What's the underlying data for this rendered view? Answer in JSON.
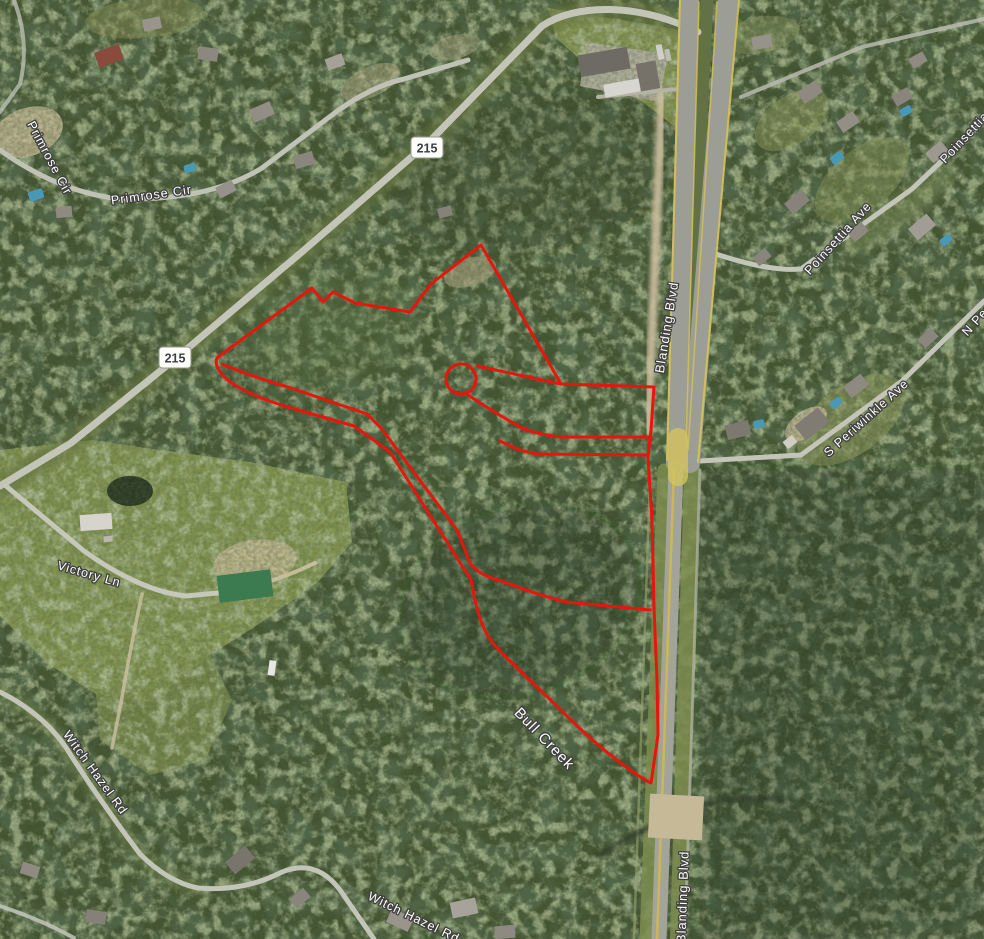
{
  "map": {
    "kind": "satellite-imagery-with-parcel-outline",
    "base_color": "#43532f",
    "boundary_color": "#e8150c",
    "pool_color": "#4898b8",
    "labels": [
      {
        "text": "Primrose Cir",
        "x": 46,
        "y": 160,
        "rot": 62,
        "size": 12.5
      },
      {
        "text": "Primrose Cir",
        "x": 152,
        "y": 199,
        "rot": -8,
        "size": 12.5
      },
      {
        "text": "Blanding Blvd",
        "x": 671,
        "y": 328,
        "rot": -81,
        "size": 13
      },
      {
        "text": "Blanding Blvd",
        "x": 687,
        "y": 897,
        "rot": -88,
        "size": 13
      },
      {
        "text": "Bull Creek",
        "x": 541,
        "y": 742,
        "rot": 46,
        "size": 15
      },
      {
        "text": "Victory Ln",
        "x": 88,
        "y": 578,
        "rot": 16,
        "size": 12.5
      },
      {
        "text": "Witch Hazel Rd",
        "x": 92,
        "y": 775,
        "rot": 54,
        "size": 12.5
      },
      {
        "text": "Witch Hazel Rd",
        "x": 412,
        "y": 921,
        "rot": 26,
        "size": 12.5
      },
      {
        "text": "Poinsettia Ave",
        "x": 977,
        "y": 130,
        "rot": -47,
        "size": 12.5
      },
      {
        "text": "Poinsettia Ave",
        "x": 841,
        "y": 241,
        "rot": -48,
        "size": 12.5
      },
      {
        "text": "S Periwinkle Ave",
        "x": 869,
        "y": 421,
        "rot": -42,
        "size": 12.5
      },
      {
        "text": "N Periwinkle Ave",
        "x": 1004,
        "y": 296,
        "rot": -48,
        "size": 12.5
      }
    ],
    "shields": [
      {
        "text": "215",
        "x": 427,
        "y": 148
      },
      {
        "text": "215",
        "x": 175,
        "y": 358
      }
    ],
    "boundary": {
      "stroke_width": 3,
      "paths": [
        "M 218,357 L 312,288 L 323,302 L 333,292 L 355,303 L 410,312 L 431,284 L 481,245 L 561,384 L 654,387 L 651,430 L 648,458 L 652,520 L 654,608 L 657,680 L 658,735 L 651,783 C 637,776 616,760 596,743 C 576,726 556,705 538,688 C 520,671 500,652 492,642 C 482,629 477,611 474,595 L 471,580 L 390,452 L 354,426 L 291,408 C 268,401 243,392 229,381 C 219,373 213,363 218,357 Z",
        "M 222,364 C 245,374 268,381 291,388 L 367,414 L 381,428 L 457,530 L 470,563 C 477,573 489,578 502,581 C 524,590 546,597 566,602 L 650,610",
        "M 477,366 L 561,384",
        "M 465,393 C 486,407 507,420 524,429 C 538,434 550,436 562,437 L 651,437",
        "M 500,441 C 516,449 527,453 538,454 L 648,455 L 648,458"
      ],
      "bulb": {
        "cx": 461,
        "cy": 379,
        "r": 15
      }
    },
    "fields": [
      {
        "name": "pasture-southwest",
        "d": "M 0,450 L 92,440 L 160,450 L 250,462 L 346,482 L 352,542 L 318,582 L 262,622 L 210,655 L 152,702 L 96,694 L 48,664 L 0,616 Z",
        "color": "#8a9a52",
        "op": 0.9
      },
      {
        "name": "pasture-lower",
        "d": "M 96,694 L 210,655 L 232,700 L 205,760 L 150,775 L 100,740 Z",
        "color": "#7f8f4c",
        "op": 0.8
      },
      {
        "name": "grass-top-center",
        "d": "M 548,8 L 660,26 L 697,34 L 676,128 L 640,100 L 592,70 L 556,38 Z",
        "color": "#8f9c55",
        "op": 0.9
      }
    ],
    "clearings": [
      {
        "name": "sand-patch",
        "cx": 28,
        "cy": 132,
        "rx": 36,
        "ry": 24,
        "rot": -20,
        "color": "#c4b893",
        "op": 0.85
      },
      {
        "name": "sand-patch",
        "cx": 370,
        "cy": 82,
        "rx": 32,
        "ry": 15,
        "rot": -25,
        "color": "#b2aa86",
        "op": 0.6
      },
      {
        "name": "sand-patch",
        "cx": 455,
        "cy": 47,
        "rx": 26,
        "ry": 12,
        "rot": -15,
        "color": "#a9a482",
        "op": 0.55
      },
      {
        "name": "clearing-in-parcel",
        "cx": 470,
        "cy": 272,
        "rx": 27,
        "ry": 14,
        "rot": -18,
        "color": "#a59d7a",
        "op": 0.75
      },
      {
        "name": "grass-clearing",
        "cx": 851,
        "cy": 420,
        "rx": 62,
        "ry": 34,
        "rot": -36,
        "color": "#939b5d",
        "op": 0.6
      },
      {
        "name": "sand-patch",
        "cx": 806,
        "cy": 424,
        "rx": 24,
        "ry": 13,
        "rot": -36,
        "color": "#c7ba96",
        "op": 0.85
      },
      {
        "name": "grass-clearing",
        "cx": 862,
        "cy": 180,
        "rx": 56,
        "ry": 30,
        "rot": -40,
        "color": "#8c9857",
        "op": 0.5
      },
      {
        "name": "grass-clearing",
        "cx": 792,
        "cy": 120,
        "rx": 42,
        "ry": 24,
        "rot": -35,
        "color": "#98a05f",
        "op": 0.5
      },
      {
        "name": "sand-yard",
        "cx": 255,
        "cy": 562,
        "rx": 42,
        "ry": 22,
        "rot": -8,
        "color": "#c8bb96",
        "op": 0.8
      },
      {
        "name": "pond",
        "cx": 130,
        "cy": 491,
        "rx": 23,
        "ry": 15,
        "rot": 0,
        "color": "#222f1e",
        "op": 0.9
      },
      {
        "name": "grass-strip",
        "cx": 900,
        "cy": 210,
        "rx": 70,
        "ry": 16,
        "rot": -38,
        "color": "#7f8e53",
        "op": 0.5,
        "blur": "b4"
      },
      {
        "name": "grass-top-edge",
        "cx": 145,
        "cy": 18,
        "rx": 60,
        "ry": 20,
        "rot": -5,
        "color": "#8f9156",
        "op": 0.5
      },
      {
        "name": "grass-clearing",
        "cx": 760,
        "cy": 35,
        "rx": 40,
        "ry": 18,
        "rot": -10,
        "color": "#87945a",
        "op": 0.5
      },
      {
        "name": "dark-forest-east",
        "d": "M 700,470 L 984,470 L 984,939 L 700,939 Z",
        "color": "#1f2c1a",
        "op": 0.28,
        "blur": "b10"
      },
      {
        "name": "dark-forest-mid",
        "cx": 520,
        "cy": 600,
        "rx": 120,
        "ry": 90,
        "rot": -20,
        "color": "#25321e",
        "op": 0.3,
        "blur": "b12"
      },
      {
        "name": "dark-forest-top",
        "cx": 530,
        "cy": 170,
        "rx": 150,
        "ry": 80,
        "rot": -10,
        "color": "#2a3822",
        "op": 0.25,
        "blur": "b12"
      },
      {
        "name": "light-canopy-west",
        "cx": 330,
        "cy": 330,
        "rx": 90,
        "ry": 60,
        "rot": -15,
        "color": "#5d7040",
        "op": 0.3,
        "blur": "b10"
      },
      {
        "name": "concrete-pad",
        "d": "M 586,42 L 668,54 L 659,102 L 580,86 Z",
        "color": "#b7b2a2",
        "op": 0.9
      }
    ],
    "roads": [
      {
        "name": "rd-215-verge",
        "d": "M 698,32 C 636,2 575,4 542,26 L 430,141 L 303,251 L 175,359 L 71,443 L 0,486",
        "w": 22,
        "color": "#66753f",
        "op": 0.7,
        "blur": "b4"
      },
      {
        "name": "witch-hazel-verge",
        "d": "M 0,692 Q 48,716 72,757 Q 103,805 140,854 Q 168,882 198,888",
        "w": 14,
        "color": "#6b7a45",
        "op": 0.6,
        "blur": "b4"
      },
      {
        "name": "blanding-verge-west",
        "d": "M 664,470 L 646,939",
        "w": 13,
        "color": "#7d8d50",
        "op": 0.85
      },
      {
        "name": "blanding-verge-east",
        "d": "M 692,470 L 678,939",
        "w": 16,
        "color": "#7d8d50",
        "op": 0.85
      },
      {
        "name": "blanding-median",
        "d": "M 707,0 L 684,445",
        "w": 13,
        "color": "#637244",
        "op": 1
      },
      {
        "name": "blanding-dirt-strip",
        "d": "M 662,92 Q 655,260 648,432",
        "w": 9,
        "color": "#ccbe9e",
        "op": 0.9,
        "blur": "b2"
      },
      {
        "name": "rd-215",
        "d": "M 698,32 C 636,2 575,4 542,26 L 430,141 L 303,251 L 175,359 L 71,443 L 0,486",
        "w": 7,
        "color": "#c3c5b9",
        "op": 1
      },
      {
        "name": "primrose-cir-rd",
        "d": "M 0,150 Q 58,192 120,199 Q 208,201 262,168 L 336,112 Q 372,86 404,79 L 468,60",
        "w": 5,
        "color": "#c0c2b6",
        "op": 1
      },
      {
        "name": "corner-rd-northwest",
        "d": "M 14,0 Q 30,42 20,84 L 0,112",
        "w": 4,
        "color": "#bcbeb2",
        "op": 0.8
      },
      {
        "name": "victory-ln-rd",
        "d": "M 6,486 L 84,551 Q 140,591 186,596 L 238,591",
        "w": 5,
        "color": "#c6c8bc",
        "op": 1
      },
      {
        "name": "victory-dirt",
        "d": "M 238,591 Q 280,580 315,563",
        "w": 4,
        "color": "#cdc1a3",
        "op": 0.9
      },
      {
        "name": "victory-driveway",
        "d": "M 142,594 Q 130,650 121,703 L 112,748",
        "w": 3.5,
        "color": "#cdc1a3",
        "op": 0.8
      },
      {
        "name": "witch-hazel-rd",
        "d": "M 0,692 Q 48,716 72,757 Q 103,805 140,854 Q 168,882 198,888 Q 243,892 282,872 Q 316,858 340,890 L 374,939",
        "w": 5,
        "color": "#c3c5b9",
        "op": 1
      },
      {
        "name": "poinsettia-ave-rd",
        "d": "M 710,252 Q 768,272 801,269 L 912,189 L 984,121",
        "w": 5,
        "color": "#c3c5b9",
        "op": 1
      },
      {
        "name": "periwinkle-ave-rd",
        "d": "M 683,462 L 801,455 L 902,381 L 984,301",
        "w": 5,
        "color": "#c3c5b9",
        "op": 1
      },
      {
        "name": "top-right-rd",
        "d": "M 741,97 L 862,47 L 984,19",
        "w": 4,
        "color": "#b8bab0",
        "op": 0.85
      },
      {
        "name": "complex-driveway",
        "d": "M 598,97 Q 645,92 689,88",
        "w": 4,
        "color": "#b5b2a6",
        "op": 1
      },
      {
        "name": "bottom-left-rd",
        "d": "M 0,906 Q 42,920 74,938",
        "w": 4,
        "color": "#bfc1b5",
        "op": 0.9
      },
      {
        "name": "blanding-west-carriageway",
        "d": "M 689,0 L 676,463",
        "w": 20,
        "color": "#9c9d94",
        "op": 1
      },
      {
        "name": "blanding-east-carriageway",
        "d": "M 728,0 L 690,463",
        "w": 20,
        "color": "#9c9d94",
        "op": 1
      },
      {
        "name": "blanding-lower",
        "d": "M 676,468 L 659,939",
        "w": 15,
        "color": "#a2a399",
        "op": 1
      },
      {
        "name": "blanding-stripe",
        "d": "M 680,0 L 667,460",
        "w": 2,
        "color": "#d8c253",
        "op": 0.9
      },
      {
        "name": "blanding-stripe",
        "d": "M 739,0 L 698,462",
        "w": 2,
        "color": "#d8c253",
        "op": 0.9
      },
      {
        "name": "blanding-stripe",
        "d": "M 699,2 L 686,445",
        "w": 1.5,
        "color": "#d8c253",
        "op": 0.8
      },
      {
        "name": "blanding-stripe",
        "d": "M 717,2 L 688,450",
        "w": 1.5,
        "color": "#d8c253",
        "op": 0.8
      },
      {
        "name": "blanding-center-stripe",
        "d": "M 674,470 L 657,939",
        "w": 2.5,
        "color": "#d2b94e",
        "op": 0.9
      },
      {
        "name": "blanding-turn-lane",
        "d": "M 678,438 L 678,476",
        "w": 20,
        "color": "#d5c35e",
        "op": 0.8
      },
      {
        "name": "shoulder-trail-east",
        "d": "M 700,470 L 685,939",
        "w": 3,
        "color": "#b5b7aa",
        "op": 0.7
      },
      {
        "name": "shoulder-trail-west",
        "d": "M 650,480 L 634,939",
        "w": 2.5,
        "color": "#9aa572",
        "op": 0.6
      },
      {
        "name": "bull-creek-channel",
        "d": "M 596,856 Q 652,822 700,806 Q 745,794 784,800",
        "w": 5,
        "color": "#2c3a26",
        "op": 0.8,
        "blur": "b2"
      }
    ],
    "buildings": [
      {
        "name": "commercial-building",
        "x": 604,
        "y": 62,
        "w": 50,
        "h": 22,
        "rot": -10,
        "color": "#6e6a64"
      },
      {
        "name": "commercial-building",
        "x": 648,
        "y": 76,
        "w": 20,
        "h": 28,
        "rot": -10,
        "color": "#767169"
      },
      {
        "name": "commercial-building",
        "x": 622,
        "y": 88,
        "w": 36,
        "h": 13,
        "rot": -10,
        "color": "#d7d5cf"
      },
      {
        "name": "truck",
        "x": 660,
        "y": 52,
        "w": 6,
        "h": 15,
        "rot": -12,
        "color": "#cfcfca"
      },
      {
        "name": "truck",
        "x": 668,
        "y": 55,
        "w": 5,
        "h": 12,
        "rot": -12,
        "color": "#bdbdb8"
      },
      {
        "name": "house",
        "x": 109,
        "y": 56,
        "w": 26,
        "h": 16,
        "rot": -20,
        "color": "#8a4a3c"
      },
      {
        "name": "house",
        "x": 152,
        "y": 24,
        "w": 18,
        "h": 12,
        "rot": -12,
        "color": "#9a958c"
      },
      {
        "name": "house",
        "x": 208,
        "y": 54,
        "w": 20,
        "h": 13,
        "rot": 8,
        "color": "#8d887f"
      },
      {
        "name": "house",
        "x": 262,
        "y": 112,
        "w": 22,
        "h": 14,
        "rot": -24,
        "color": "#938e85"
      },
      {
        "name": "house",
        "x": 304,
        "y": 160,
        "w": 20,
        "h": 13,
        "rot": -16,
        "color": "#8b867d"
      },
      {
        "name": "house",
        "x": 226,
        "y": 189,
        "w": 18,
        "h": 12,
        "rot": -28,
        "color": "#96918a"
      },
      {
        "name": "house",
        "x": 64,
        "y": 212,
        "w": 16,
        "h": 11,
        "rot": -5,
        "color": "#8f8a81"
      },
      {
        "name": "house",
        "x": 335,
        "y": 62,
        "w": 18,
        "h": 12,
        "rot": -20,
        "color": "#a6a198"
      },
      {
        "name": "house",
        "x": 445,
        "y": 212,
        "w": 14,
        "h": 10,
        "rot": -15,
        "color": "#86817a"
      },
      {
        "name": "house",
        "x": 762,
        "y": 42,
        "w": 20,
        "h": 13,
        "rot": -10,
        "color": "#98938a"
      },
      {
        "name": "house",
        "x": 810,
        "y": 92,
        "w": 22,
        "h": 14,
        "rot": -34,
        "color": "#8f8a81"
      },
      {
        "name": "house",
        "x": 848,
        "y": 122,
        "w": 20,
        "h": 13,
        "rot": -34,
        "color": "#948f86"
      },
      {
        "name": "house",
        "x": 902,
        "y": 97,
        "w": 18,
        "h": 12,
        "rot": -30,
        "color": "#8a857c"
      },
      {
        "name": "house",
        "x": 937,
        "y": 152,
        "w": 20,
        "h": 13,
        "rot": -40,
        "color": "#9e9990"
      },
      {
        "name": "house",
        "x": 797,
        "y": 202,
        "w": 22,
        "h": 14,
        "rot": -40,
        "color": "#88837a"
      },
      {
        "name": "house",
        "x": 858,
        "y": 232,
        "w": 18,
        "h": 12,
        "rot": -40,
        "color": "#8f8a81"
      },
      {
        "name": "house",
        "x": 922,
        "y": 227,
        "w": 24,
        "h": 15,
        "rot": -40,
        "color": "#a29d94"
      },
      {
        "name": "house",
        "x": 762,
        "y": 257,
        "w": 16,
        "h": 11,
        "rot": -40,
        "color": "#8a857c"
      },
      {
        "name": "house",
        "x": 918,
        "y": 60,
        "w": 16,
        "h": 11,
        "rot": -30,
        "color": "#908b82"
      },
      {
        "name": "house",
        "x": 812,
        "y": 424,
        "w": 30,
        "h": 19,
        "rot": -38,
        "color": "#807b73"
      },
      {
        "name": "house",
        "x": 790,
        "y": 442,
        "w": 12,
        "h": 9,
        "rot": -38,
        "color": "#d0cdc5"
      },
      {
        "name": "house",
        "x": 856,
        "y": 386,
        "w": 22,
        "h": 14,
        "rot": -38,
        "color": "#8f8a81"
      },
      {
        "name": "house",
        "x": 738,
        "y": 430,
        "w": 24,
        "h": 15,
        "rot": -14,
        "color": "#7d7870"
      },
      {
        "name": "house",
        "x": 928,
        "y": 338,
        "w": 18,
        "h": 12,
        "rot": -42,
        "color": "#8b867d"
      },
      {
        "name": "farm-building",
        "x": 96,
        "y": 522,
        "w": 32,
        "h": 16,
        "rot": -4,
        "color": "#d6d4cd"
      },
      {
        "name": "shed",
        "x": 108,
        "y": 539,
        "w": 9,
        "h": 6,
        "rot": -4,
        "color": "#b9b7b0"
      },
      {
        "name": "green-roof-building",
        "x": 245,
        "y": 586,
        "w": 54,
        "h": 27,
        "rot": -7,
        "color": "#3c7a50"
      },
      {
        "name": "bridge",
        "x": 676,
        "y": 817,
        "w": 54,
        "h": 44,
        "rot": 3,
        "color": "#c6b997"
      },
      {
        "name": "house",
        "x": 240,
        "y": 860,
        "w": 26,
        "h": 16,
        "rot": -40,
        "color": "#79746c"
      },
      {
        "name": "house",
        "x": 300,
        "y": 898,
        "w": 18,
        "h": 12,
        "rot": -40,
        "color": "#8a857c"
      },
      {
        "name": "house",
        "x": 400,
        "y": 920,
        "w": 24,
        "h": 15,
        "rot": 25,
        "color": "#9a958c"
      },
      {
        "name": "house",
        "x": 464,
        "y": 908,
        "w": 26,
        "h": 16,
        "rot": -12,
        "color": "#a8a39a"
      },
      {
        "name": "house",
        "x": 505,
        "y": 932,
        "w": 20,
        "h": 13,
        "rot": -5,
        "color": "#8f8a81"
      },
      {
        "name": "house",
        "x": 30,
        "y": 870,
        "w": 18,
        "h": 12,
        "rot": 18,
        "color": "#908b82"
      },
      {
        "name": "house",
        "x": 96,
        "y": 917,
        "w": 20,
        "h": 13,
        "rot": 8,
        "color": "#85807a"
      },
      {
        "name": "truck",
        "x": 272,
        "y": 668,
        "w": 7,
        "h": 15,
        "rot": 8,
        "color": "#e6e6e2"
      }
    ],
    "pools": [
      {
        "x": 36,
        "y": 195,
        "w": 15,
        "h": 10,
        "rot": -18
      },
      {
        "x": 190,
        "y": 168,
        "w": 12,
        "h": 8,
        "rot": -18
      },
      {
        "x": 837,
        "y": 158,
        "w": 13,
        "h": 9,
        "rot": -35
      },
      {
        "x": 906,
        "y": 111,
        "w": 12,
        "h": 8,
        "rot": -30
      },
      {
        "x": 946,
        "y": 240,
        "w": 12,
        "h": 8,
        "rot": -40
      },
      {
        "x": 836,
        "y": 403,
        "w": 12,
        "h": 8,
        "rot": -38
      },
      {
        "x": 759,
        "y": 424,
        "w": 11,
        "h": 8,
        "rot": -12
      }
    ]
  }
}
